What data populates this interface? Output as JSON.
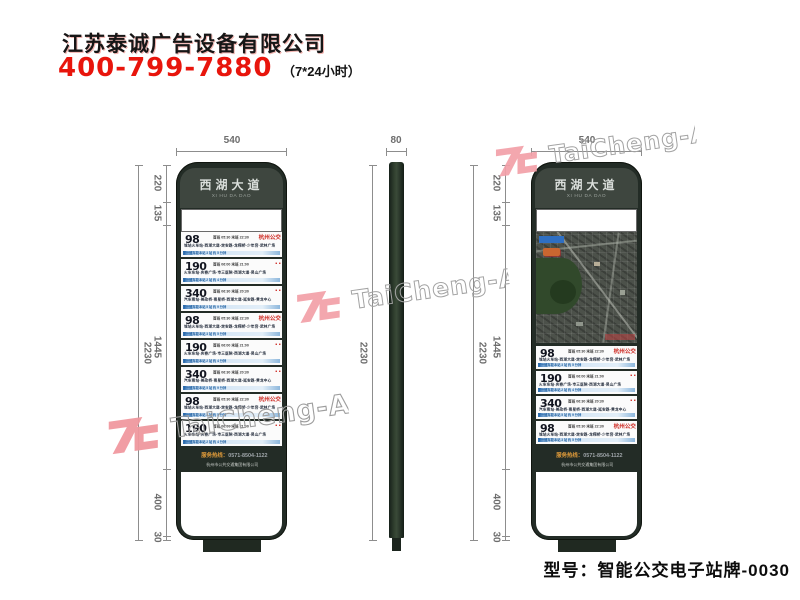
{
  "header": {
    "company": "江苏泰诚广告设备有限公司",
    "phone": "400-799-7880",
    "hours": "（7*24小时）"
  },
  "model": {
    "label": "型号：智能公交电子站牌-0030"
  },
  "watermark": {
    "text": "TaiCheng-AD",
    "logo": "TC",
    "pink": "#f2a0a8",
    "gray": "#a3a3a3"
  },
  "colors": {
    "accent_red": "#e8150c",
    "frame_green": "#232c26",
    "card_blue_strip": "#8db7dc"
  },
  "sign": {
    "title": "西湖大道",
    "pinyin": "XI HU DA DAO",
    "svc_label": "服务热线：",
    "svc_number": "0571-8504-1122",
    "svc_company": "杭州市公共交通集团有限公司"
  },
  "dims": {
    "front_width": "540",
    "side_width": "80",
    "total": "2230",
    "segments": [
      "220",
      "135",
      "1445",
      "400",
      "30"
    ]
  },
  "routes": {
    "98": {
      "no": "98",
      "times": "首班 05:30  末班 22:30",
      "mark": "杭州公交",
      "stations": "城站火车站-西湖大道-定安路-龙翔桥-少年宫-武林广场",
      "strip": "下一班车距本站 3 站 约 5 分钟"
    },
    "190": {
      "no": "190",
      "times": "首班 06:00  末班 21:00",
      "mark": "▪ ▪",
      "stations": "火车东站-庆春广场-市三医院-西湖大道-吴山广场",
      "strip": "下一班车距本站 2 站 约 4 分钟"
    },
    "340": {
      "no": "340",
      "times": "首班 06:30  末班 20:30",
      "mark": "▪ ▪",
      "stations": "汽车南站-美政桥-南星桥-西湖大道-延安路-黄龙中心",
      "strip": "下一班车距本站 5 站 约 9 分钟"
    }
  },
  "left_order": [
    "98",
    "190",
    "340",
    "98",
    "190",
    "340",
    "98",
    "190"
  ],
  "right_order": [
    "98",
    "190",
    "340",
    "98"
  ]
}
